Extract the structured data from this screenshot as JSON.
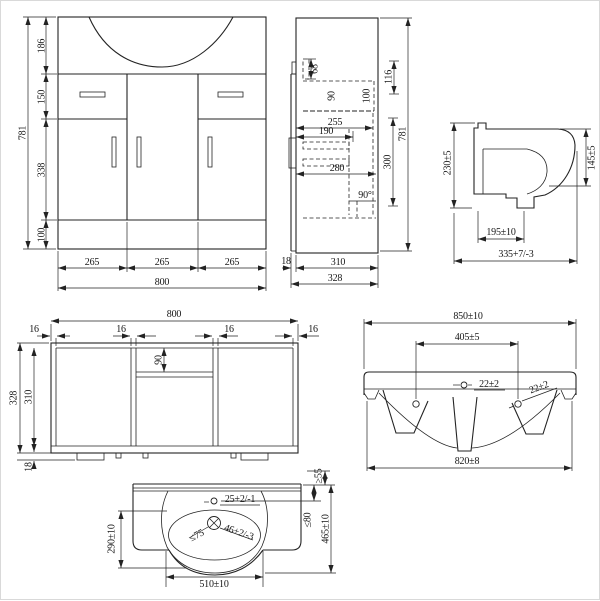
{
  "front_view": {
    "total_height": "781",
    "segments": [
      "186",
      "150",
      "338",
      "100"
    ],
    "columns": [
      "265",
      "265",
      "265"
    ],
    "total_width": "800"
  },
  "side_view": {
    "d68": "68",
    "d90": "90",
    "d100": "100",
    "d116": "116",
    "d255": "255",
    "d190": "190",
    "d280": "280",
    "angle": "90°",
    "d300": "300",
    "total_height": "781",
    "d18": "18",
    "d310": "310",
    "d328": "328"
  },
  "basin_side_view": {
    "back_height": "230±5",
    "front_height": "145±5",
    "depth_195": "195±10",
    "depth_335": "335+7/-3"
  },
  "plan_view": {
    "total_width": "800",
    "thicknesses": [
      "16",
      "16",
      "16",
      "16"
    ],
    "shelf_90": "90",
    "d328": "328",
    "d310": "310",
    "d18": "18"
  },
  "basin_front_view": {
    "total_width": "850±10",
    "tap_centres": "405±5",
    "holes": [
      "22±2",
      "22±2"
    ],
    "base_width": "820±8"
  },
  "basin_plan_view": {
    "back_ledge": "≥55",
    "tap_setback": "≤80",
    "total_depth": "465±10",
    "bowl_depth": "290±10",
    "bowl_width": "510±10",
    "tap_hole": "25+2/-1",
    "waste_max": "≤75",
    "overflow": "46+2/-3"
  }
}
